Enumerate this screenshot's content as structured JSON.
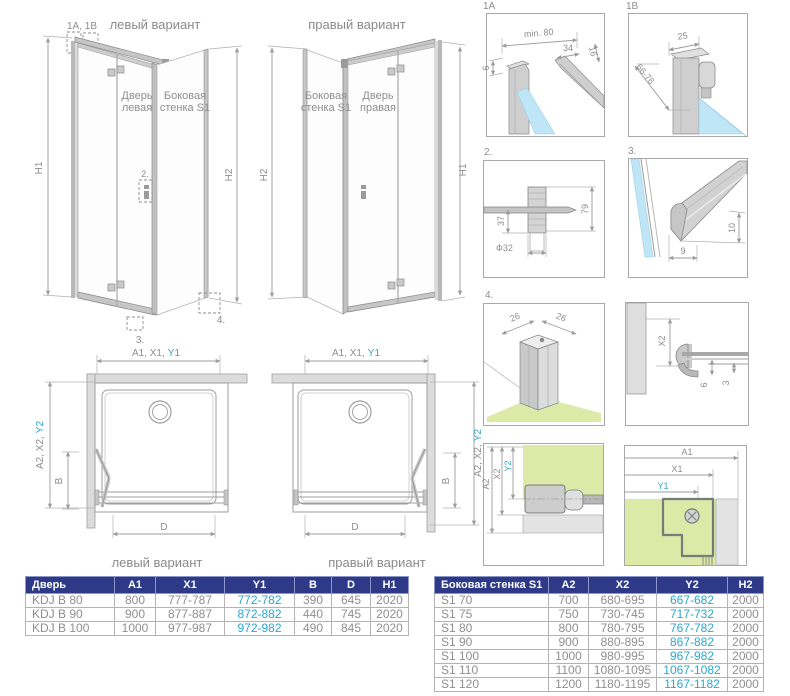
{
  "colors": {
    "accent_cyan": "#2ba7cf",
    "table_header_bg": "#2e3a87",
    "table_header_text": "#ffffff",
    "dim_gray": "#8d8d8d",
    "glass_blue": "#bfe6f6",
    "floor_green": "#dde9a6",
    "profile_gray": "#cfcfcf"
  },
  "iso_left": {
    "title": "левый вариант",
    "callout_1ab": "1A, 1B",
    "callout_2": "2.",
    "callout_3": "3.",
    "callout_4": "4.",
    "door_line1": "Дверь",
    "door_line2": "левая",
    "side_line1": "Боковая",
    "side_line2": "стенка S1",
    "h1": "H1",
    "h2": "H2"
  },
  "iso_right": {
    "title": "правый вариант",
    "side_line1": "Боковая",
    "side_line2": "стенка S1",
    "door_line1": "Дверь",
    "door_line2": "правая",
    "h1": "H1",
    "h2": "H2"
  },
  "plan_left": {
    "top_prefix": "A1, X1,",
    "top_accent": "Y1",
    "side_prefix": "A2, X2,",
    "side_accent": "Y2",
    "dim_b": "B",
    "dim_d": "D",
    "caption": "левый вариант"
  },
  "plan_right": {
    "top_prefix": "A1, X1,",
    "top_accent": "Y1",
    "side_prefix": "A2, X2,",
    "side_accent": "Y2",
    "dim_b": "B",
    "dim_d": "D",
    "caption": "правый вариант"
  },
  "details": {
    "d1a": {
      "label": "1A",
      "min80": "min. 80",
      "d34": "34",
      "d16": "16",
      "d6": "6"
    },
    "d1b": {
      "label": "1B",
      "d25": "25",
      "d66": "66-76"
    },
    "d2": {
      "label": "2.",
      "d37": "37",
      "d79": "79",
      "f32": "Ф32"
    },
    "d3": {
      "label": "3.",
      "d9": "9",
      "d10": "10"
    },
    "d4": {
      "label": "4.",
      "d26a": "26",
      "d26b": "26"
    },
    "d5": {
      "x2": "X2",
      "d6": "6",
      "d3": "3"
    },
    "d6": {
      "a2": "A2",
      "x2": "X2",
      "y2": "Y2"
    },
    "d7": {
      "a1": "A1",
      "x1": "X1",
      "y1": "Y1"
    }
  },
  "tables": {
    "door": {
      "headers": [
        "Дверь",
        "A1",
        "X1",
        "Y1",
        "B",
        "D",
        "H1"
      ],
      "rows": [
        [
          "KDJ B 80",
          "800",
          "777-787",
          "772-782",
          "390",
          "645",
          "2020"
        ],
        [
          "KDJ B 90",
          "900",
          "877-887",
          "872-882",
          "440",
          "745",
          "2020"
        ],
        [
          "KDJ B 100",
          "1000",
          "977-987",
          "972-982",
          "490",
          "845",
          "2020"
        ]
      ]
    },
    "side": {
      "headers": [
        "Боковая стенка S1",
        "A2",
        "X2",
        "Y2",
        "H2"
      ],
      "rows": [
        [
          "S1 70",
          "700",
          "680-695",
          "667-682",
          "2000"
        ],
        [
          "S1 75",
          "750",
          "730-745",
          "717-732",
          "2000"
        ],
        [
          "S1 80",
          "800",
          "780-795",
          "767-782",
          "2000"
        ],
        [
          "S1 90",
          "900",
          "880-895",
          "867-882",
          "2000"
        ],
        [
          "S1 100",
          "1000",
          "980-995",
          "967-982",
          "2000"
        ],
        [
          "S1 110",
          "1100",
          "1080-1095",
          "1067-1082",
          "2000"
        ],
        [
          "S1 120",
          "1200",
          "1180-1195",
          "1167-1182",
          "2000"
        ]
      ]
    }
  }
}
